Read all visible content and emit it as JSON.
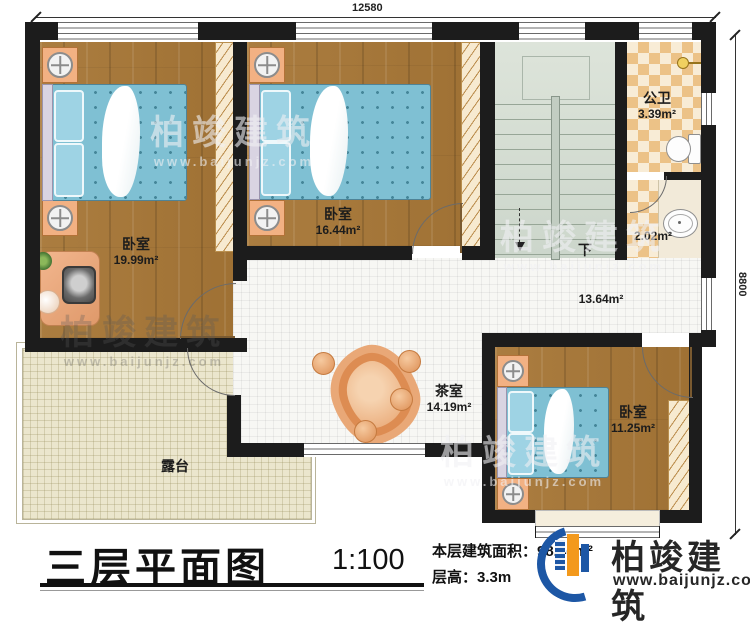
{
  "plan": {
    "dimension_top": "12580",
    "dimension_right": "8800",
    "rooms": {
      "bedroom1": {
        "label": "卧室",
        "area": "19.99m²"
      },
      "bedroom2": {
        "label": "卧室",
        "area": "16.44m²"
      },
      "bedroom3": {
        "label": "卧室",
        "area": "11.25m²"
      },
      "bathroom": {
        "label": "公卫",
        "area": "3.39m²"
      },
      "washroom": {
        "area": "2.02m²"
      },
      "hall": {
        "area": "13.64m²"
      },
      "tearoom": {
        "label": "茶室",
        "area": "14.19m²"
      },
      "terrace": {
        "label": "露台"
      }
    },
    "stairs": {
      "direction_label": "下"
    }
  },
  "title_block": {
    "title": "三层平面图",
    "scale": "1:100",
    "floor_area": "本层建筑面积：98.46m²",
    "floor_height": "层高：3.3m"
  },
  "branding": {
    "company": "柏竣建筑",
    "website": "www.baijunjz.com"
  },
  "watermark": {
    "company": "柏竣建筑",
    "website": "www.baijunjz.com"
  },
  "colors": {
    "wall": "#1c1c1c",
    "wood_floor": "#a97b3c",
    "checker_tile": "#ecc287",
    "terrace": "#ebe6cd",
    "stairs": "#d3dcd2",
    "bed": "#7fc0d3",
    "logo_blue": "#1d57a5",
    "logo_orange": "#f3991c"
  }
}
